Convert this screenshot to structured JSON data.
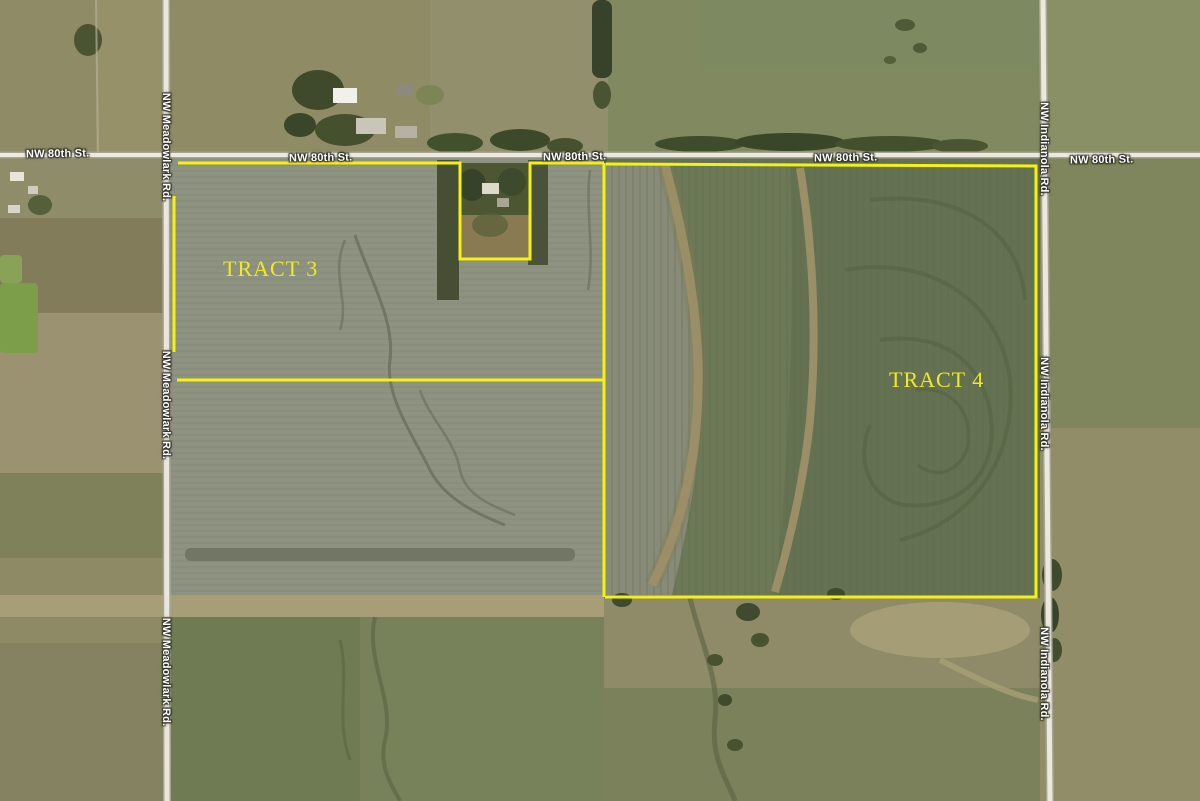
{
  "view": {
    "type": "aerial-satellite-map",
    "description": "Satellite plat map of farmland with two outlined auction tracts"
  },
  "colors": {
    "boundary": "#f5f111",
    "tract_label": "#efe928",
    "road_label": "#ffffff",
    "road_surface": "#ebe8dc"
  },
  "tracts": [
    {
      "label": "TRACT 3"
    },
    {
      "label": "TRACT 4"
    }
  ],
  "roads": {
    "north_street": {
      "name": "NW 80th St.",
      "orientation": "horizontal",
      "label_instances": 5
    },
    "west_road": {
      "name": "NW Meadowlark Rd.",
      "orientation": "vertical",
      "label_instances": 3
    },
    "east_road": {
      "name": "NW Indianola Rd.",
      "orientation": "vertical",
      "label_instances": 3
    }
  }
}
